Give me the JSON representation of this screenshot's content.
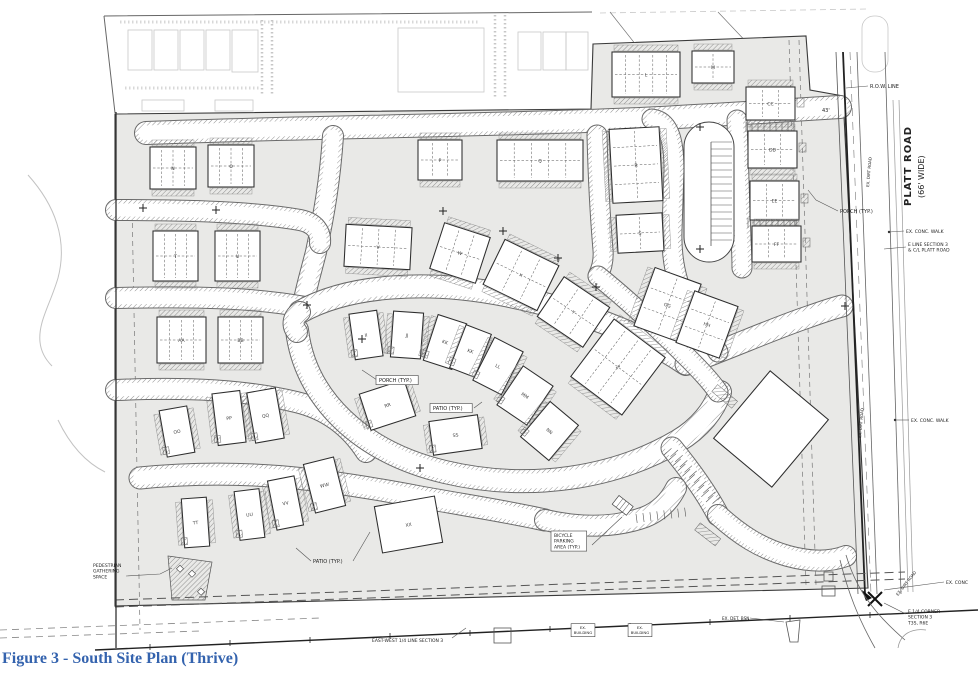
{
  "figure": {
    "caption": "Figure 3 - South Site Plan (Thrive)"
  },
  "platt_road": {
    "name": "PLATT ROAD",
    "width_note": "(66' WIDE)"
  },
  "plan": {
    "buildings": [
      {
        "label": "N",
        "x": 150,
        "y": 147,
        "w": 46,
        "h": 42,
        "a": 0,
        "kind": "row",
        "units": 4
      },
      {
        "label": "O",
        "x": 208,
        "y": 145,
        "w": 46,
        "h": 42,
        "a": 0,
        "kind": "row",
        "units": 4
      },
      {
        "label": "T",
        "x": 153,
        "y": 231,
        "w": 45,
        "h": 50,
        "a": 0,
        "kind": "row",
        "units": 4
      },
      {
        "label": "U",
        "x": 215,
        "y": 231,
        "w": 45,
        "h": 50,
        "a": 0,
        "kind": "row",
        "units": 4
      },
      {
        "label": "AA",
        "x": 157,
        "y": 317,
        "w": 49,
        "h": 46,
        "a": 0,
        "kind": "row",
        "units": 4
      },
      {
        "label": "BB",
        "x": 218,
        "y": 317,
        "w": 45,
        "h": 46,
        "a": 0,
        "kind": "row",
        "units": 4
      },
      {
        "label": "P",
        "x": 418,
        "y": 140,
        "w": 44,
        "h": 40,
        "a": 0,
        "kind": "row",
        "units": 3
      },
      {
        "label": "Q",
        "x": 497,
        "y": 140,
        "w": 86,
        "h": 41,
        "a": 0,
        "kind": "row",
        "units": 5
      },
      {
        "label": "L",
        "x": 612,
        "y": 52,
        "w": 68,
        "h": 45,
        "a": 0,
        "kind": "row",
        "units": 5
      },
      {
        "label": "M",
        "x": 692,
        "y": 51,
        "w": 42,
        "h": 32,
        "a": 0,
        "kind": "row",
        "units": 2
      },
      {
        "label": "R",
        "x": 611,
        "y": 128,
        "w": 50,
        "h": 74,
        "a": -3,
        "kind": "rowV",
        "units": 4
      },
      {
        "label": "S",
        "x": 617,
        "y": 214,
        "w": 46,
        "h": 38,
        "a": -3,
        "kind": "rowV",
        "units": 2
      },
      {
        "label": "CC",
        "x": 746,
        "y": 87,
        "w": 49,
        "h": 33,
        "a": 0,
        "kind": "row",
        "units": 3
      },
      {
        "label": "DD",
        "x": 748,
        "y": 131,
        "w": 49,
        "h": 37,
        "a": 0,
        "kind": "row",
        "units": 3
      },
      {
        "label": "EE",
        "x": 750,
        "y": 181,
        "w": 49,
        "h": 39,
        "a": 0,
        "kind": "row",
        "units": 3
      },
      {
        "label": "FF",
        "x": 752,
        "y": 226,
        "w": 49,
        "h": 36,
        "a": 0,
        "kind": "row",
        "units": 3
      },
      {
        "label": "V",
        "x": 345,
        "y": 226,
        "w": 66,
        "h": 42,
        "a": 3,
        "kind": "row",
        "units": 4
      },
      {
        "label": "W",
        "x": 436,
        "y": 229,
        "w": 48,
        "h": 48,
        "a": 18,
        "kind": "row",
        "units": 3
      },
      {
        "label": "X",
        "x": 491,
        "y": 250,
        "w": 60,
        "h": 50,
        "a": 26,
        "kind": "row",
        "units": 3
      },
      {
        "label": "Y",
        "x": 546,
        "y": 288,
        "w": 55,
        "h": 48,
        "a": 34,
        "kind": "row",
        "units": 3
      },
      {
        "label": "Z",
        "x": 586,
        "y": 331,
        "w": 64,
        "h": 72,
        "a": 37,
        "kind": "row",
        "units": 4
      },
      {
        "label": "GG",
        "x": 643,
        "y": 274,
        "w": 49,
        "h": 62,
        "a": 20,
        "kind": "rowV",
        "units": 3
      },
      {
        "label": "HH",
        "x": 684,
        "y": 297,
        "w": 46,
        "h": 55,
        "a": 20,
        "kind": "rowV",
        "units": 3
      },
      {
        "label": "II",
        "x": 352,
        "y": 312,
        "w": 28,
        "h": 46,
        "a": -8,
        "kind": "house"
      },
      {
        "label": "JJ",
        "x": 392,
        "y": 312,
        "w": 30,
        "h": 46,
        "a": 4,
        "kind": "house"
      },
      {
        "label": "KK",
        "x": 430,
        "y": 318,
        "w": 30,
        "h": 48,
        "a": 18,
        "kind": "house"
      },
      {
        "label": "KK",
        "x": 457,
        "y": 328,
        "w": 27,
        "h": 46,
        "a": 21,
        "kind": "house"
      },
      {
        "label": "LL",
        "x": 482,
        "y": 342,
        "w": 32,
        "h": 48,
        "a": 27,
        "kind": "house"
      },
      {
        "label": "MM",
        "x": 507,
        "y": 372,
        "w": 36,
        "h": 47,
        "a": 34,
        "kind": "house"
      },
      {
        "label": "NN",
        "x": 531,
        "y": 408,
        "w": 37,
        "h": 46,
        "a": 40,
        "kind": "house"
      },
      {
        "label": "RR",
        "x": 364,
        "y": 386,
        "w": 47,
        "h": 38,
        "a": -18,
        "kind": "house"
      },
      {
        "label": "SS",
        "x": 431,
        "y": 418,
        "w": 49,
        "h": 34,
        "a": -8,
        "kind": "house"
      },
      {
        "label": "OO",
        "x": 163,
        "y": 408,
        "w": 28,
        "h": 47,
        "a": -10,
        "kind": "house"
      },
      {
        "label": "PP",
        "x": 215,
        "y": 392,
        "w": 28,
        "h": 52,
        "a": -7,
        "kind": "house"
      },
      {
        "label": "QQ",
        "x": 251,
        "y": 390,
        "w": 29,
        "h": 51,
        "a": -10,
        "kind": "house"
      },
      {
        "label": "TT",
        "x": 183,
        "y": 498,
        "w": 25,
        "h": 49,
        "a": -4,
        "kind": "house"
      },
      {
        "label": "UU",
        "x": 237,
        "y": 490,
        "w": 25,
        "h": 49,
        "a": -7,
        "kind": "house"
      },
      {
        "label": "VV",
        "x": 272,
        "y": 478,
        "w": 27,
        "h": 50,
        "a": -11,
        "kind": "house"
      },
      {
        "label": "WW",
        "x": 309,
        "y": 460,
        "w": 31,
        "h": 50,
        "a": -14,
        "kind": "house"
      },
      {
        "label": "XX",
        "x": 378,
        "y": 501,
        "w": 61,
        "h": 47,
        "a": -10,
        "kind": "plain"
      },
      {
        "label": "",
        "x": 733,
        "y": 385,
        "w": 76,
        "h": 88,
        "a": 40,
        "kind": "plain"
      }
    ],
    "annotations": [
      {
        "name": "row-line-label",
        "text": "R.O.W. LINE",
        "x": 870,
        "y": 88,
        "size": 5,
        "leaders": [
          [
            [
              868,
              86
            ],
            [
              846,
              88
            ]
          ]
        ]
      },
      {
        "name": "dim-43",
        "text": "43'",
        "x": 822,
        "y": 112,
        "size": 5
      },
      {
        "name": "platt-road-name",
        "text": "PLATT ROAD",
        "x": 911,
        "y": 206,
        "size": 10,
        "rotate": -90,
        "bold": true,
        "ls": 1
      },
      {
        "name": "platt-road-width",
        "text": "(66' WIDE)",
        "x": 924,
        "y": 198,
        "size": 8,
        "rotate": -90
      },
      {
        "name": "porch-typ-right",
        "text": "PORCH (TYP.)",
        "x": 840,
        "y": 213,
        "size": 5,
        "leaders": [
          [
            [
              838,
              211
            ],
            [
              816,
              200
            ],
            [
              808,
              190
            ]
          ]
        ]
      },
      {
        "name": "ex-conc-walk-1",
        "text": "EX. CONC. WALK",
        "x": 906,
        "y": 233,
        "size": 4.5,
        "leaders": [
          [
            [
              904,
              231
            ],
            [
              889,
              232
            ]
          ]
        ],
        "dot": [
          889,
          232
        ]
      },
      {
        "name": "e-line-section",
        "lines": [
          "E LINE SECTION 3",
          "& C/L PLATT ROAD"
        ],
        "x": 908,
        "y": 246,
        "size": 4.5,
        "leaders": [
          [
            [
              906,
              247
            ],
            [
              884,
              249
            ]
          ]
        ]
      },
      {
        "name": "ex-conc-walk-2",
        "text": "EX. CONC. WALK",
        "x": 911,
        "y": 422,
        "size": 4.5,
        "leaders": [
          [
            [
              909,
              420
            ],
            [
              895,
              420
            ]
          ]
        ],
        "dot": [
          895,
          420
        ]
      },
      {
        "name": "ex-conc-bottom",
        "text": "EX. CONC",
        "x": 946,
        "y": 584,
        "size": 4.5,
        "leaders": [
          [
            [
              944,
              582
            ],
            [
              884,
              590
            ]
          ]
        ]
      },
      {
        "name": "e-quarter-corner",
        "lines": [
          "E 1/4 CORNER",
          "SECTION 3",
          "T3S, R6E"
        ],
        "x": 908,
        "y": 613,
        "size": 4.5,
        "leaders": [
          [
            [
              906,
              614
            ],
            [
              884,
              603
            ]
          ]
        ]
      },
      {
        "name": "east-west-quarter-line",
        "text": "EAST-WEST 1/4 LINE SECTION 3",
        "x": 372,
        "y": 642,
        "size": 4.5,
        "leaders": [
          [
            [
              452,
              638
            ],
            [
              466,
              628
            ]
          ]
        ]
      },
      {
        "name": "ex-building-1",
        "lines": [
          "EX.",
          "BUILDING"
        ],
        "x": 583,
        "y": 629,
        "size": 3.8,
        "box": true,
        "anchor": "middle"
      },
      {
        "name": "ex-building-2",
        "lines": [
          "EX.",
          "BUILDING"
        ],
        "x": 640,
        "y": 629,
        "size": 3.8,
        "box": true,
        "anchor": "middle"
      },
      {
        "name": "ex-det-bsn",
        "text": "EX. DET. BSN",
        "x": 722,
        "y": 620,
        "size": 4.2,
        "leaders": [
          [
            [
              750,
              618
            ],
            [
              784,
              622
            ]
          ]
        ]
      },
      {
        "name": "pedestrian-gathering-space",
        "lines": [
          "PEDESTRIAN",
          "GATHERING",
          "SPACE"
        ],
        "x": 93,
        "y": 567,
        "size": 4.5,
        "leaders": [
          [
            [
              126,
              576
            ],
            [
              160,
              574
            ],
            [
              172,
              568
            ]
          ]
        ]
      },
      {
        "name": "porch-typ-center",
        "text": "PORCH (TYP.)",
        "x": 379,
        "y": 382,
        "size": 5,
        "box": true,
        "leaders": [
          [
            [
              377,
              380
            ],
            [
              362,
              370
            ]
          ]
        ]
      },
      {
        "name": "patio-typ-center",
        "text": "PATIO (TYP.)",
        "x": 433,
        "y": 410,
        "size": 5,
        "box": true,
        "leaders": [
          [
            [
              474,
              408
            ],
            [
              482,
              402
            ]
          ]
        ]
      },
      {
        "name": "patio-typ-bottom",
        "text": "PATIO (TYP.)",
        "x": 313,
        "y": 563,
        "size": 5,
        "leaders": [
          [
            [
              311,
              561
            ],
            [
              296,
              548
            ]
          ],
          [
            [
              353,
              561
            ],
            [
              370,
              532
            ]
          ]
        ]
      },
      {
        "name": "bicycle-parking-area",
        "lines": [
          "BICYCLE",
          "PARKING",
          "AREA (TYP.)"
        ],
        "x": 554,
        "y": 537,
        "size": 4.5,
        "box": true,
        "leaders": [
          [
            [
              592,
              545
            ],
            [
              622,
              517
            ]
          ]
        ]
      },
      {
        "name": "ex-dirt-road-1",
        "text": "EX. DIRT ROAD",
        "x": 869,
        "y": 187,
        "size": 4,
        "rotate": -85
      },
      {
        "name": "ex-dirt-road-2",
        "text": "EX. DIRT ROAD",
        "x": 861,
        "y": 438,
        "size": 4,
        "rotate": -85
      },
      {
        "name": "ex-dirt-road-3",
        "text": "EX. DIRT ROAD",
        "x": 898,
        "y": 596,
        "size": 4,
        "rotate": -52
      }
    ]
  }
}
